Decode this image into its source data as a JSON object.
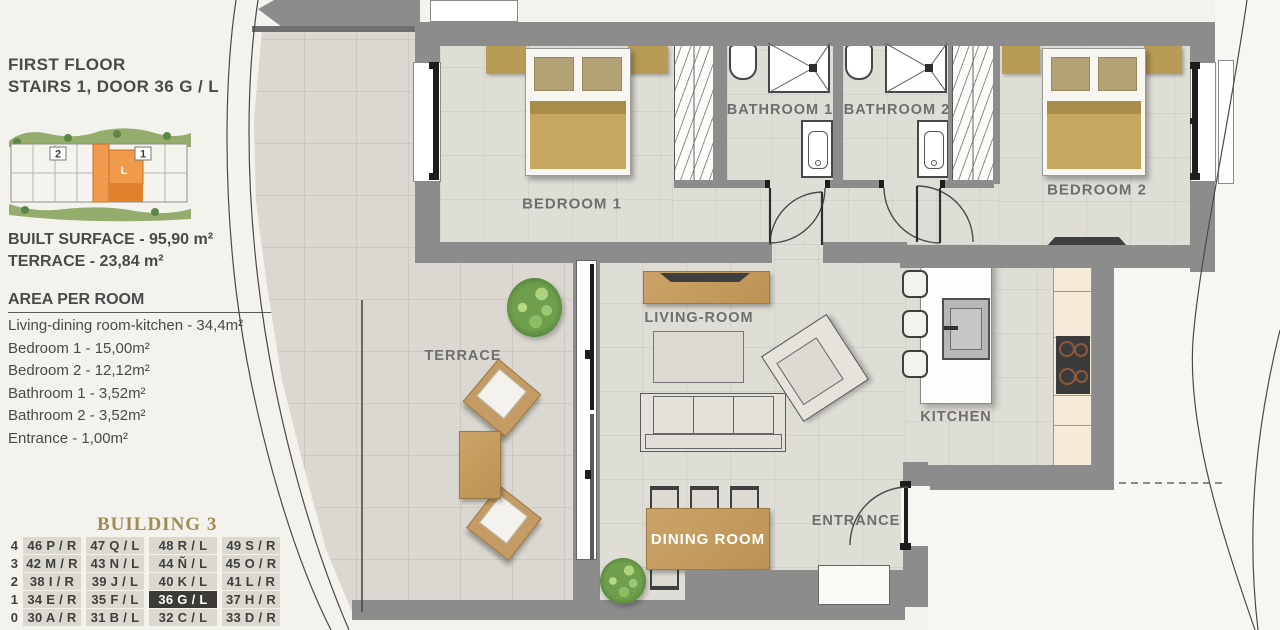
{
  "panel": {
    "title_line1": "FIRST FLOOR",
    "title_line2": "STAIRS 1, DOOR 36 G / L",
    "built_surface": "BUILT SURFACE  - 95,90 m²",
    "terrace_surface": "TERRACE - 23,84 m²",
    "area_header": "AREA PER ROOM",
    "areas": [
      "Living-dining room-kitchen - 34,4m²",
      "Bedroom 1 - 15,00m²",
      "Bedroom 2 - 12,12m²",
      "Bathroom 1 - 3,52m²",
      "Bathroom 2 - 3,52m²",
      "Entrance - 1,00m²"
    ],
    "site_map": {
      "stair_2": "2",
      "stair_1": "1",
      "unit": "L"
    }
  },
  "building_table": {
    "title": "BUILDING 3",
    "highlighted": "36 G / L",
    "rows": [
      {
        "floor": "4",
        "units": [
          "46 P / R",
          "47 Q / L",
          "48 R / L",
          "49 S / R"
        ]
      },
      {
        "floor": "3",
        "units": [
          "42 M / R",
          "43 N / L",
          "44 Ñ / L",
          "45 O / R"
        ]
      },
      {
        "floor": "2",
        "units": [
          "38 I / R",
          "39 J / L",
          "40 K / L",
          "41 L / R"
        ]
      },
      {
        "floor": "1",
        "units": [
          "34 E / R",
          "35 F / L",
          "36 G / L",
          "37 H / R"
        ]
      },
      {
        "floor": "0",
        "units": [
          "30 A / R",
          "31 B / L",
          "32 C / L",
          "33 D / R"
        ]
      }
    ]
  },
  "plan": {
    "labels": {
      "bedroom1": "BEDROOM 1",
      "bathroom1": "BATHROOM 1",
      "bathroom2": "BATHROOM 2",
      "bedroom2": "BEDROOM 2",
      "living": "LIVING-ROOM",
      "terrace": "TERRACE",
      "kitchen": "KITCHEN",
      "entrance": "ENTRANCE",
      "dining": "DINING ROOM"
    }
  },
  "colors": {
    "wall": "#8c8c8c",
    "floor": "#deddd6",
    "wood": "#c49b5e",
    "highlight_orange": "#f09a4b",
    "table_highlight": "#3b3a37",
    "label_gray": "#6e6e6e"
  }
}
